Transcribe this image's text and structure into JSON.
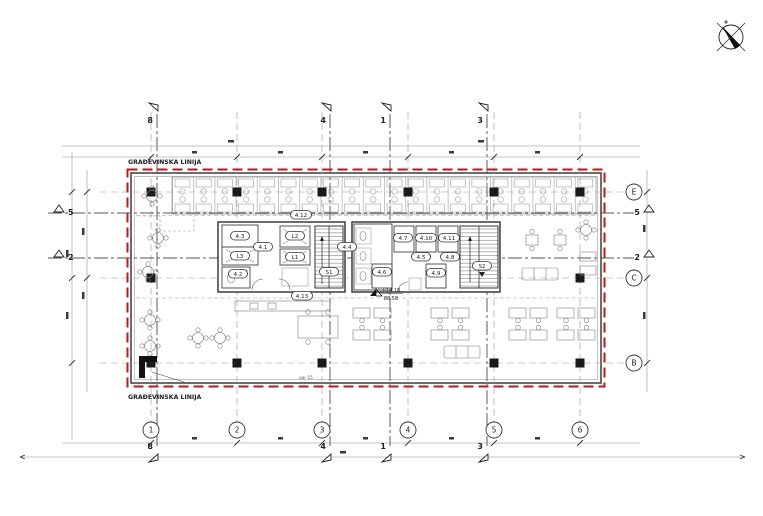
{
  "notes": {
    "building_line_top": "GRAĐEVINSKA LINIJA",
    "building_line_bottom": "GRAĐEVINSKA LINIJA",
    "par": "par 15"
  },
  "colors": {
    "building_line": "#cc1111"
  },
  "grid": {
    "columns": [
      "1",
      "2",
      "3",
      "4",
      "5",
      "6"
    ],
    "rows": [
      "E",
      "C",
      "B"
    ]
  },
  "sections": {
    "vertical": [
      "8",
      "4",
      "1",
      "3"
    ],
    "horizontal": [
      "5",
      "2"
    ]
  },
  "rooms": {
    "r41": "4.1",
    "r42": "4.2",
    "r43": "4.3",
    "r44": "4.4",
    "r45": "4.5",
    "r46": "4.6",
    "r47": "4.7",
    "r48": "4.8",
    "r49": "4.9",
    "r410": "4.10",
    "r411": "4.11",
    "r412": "4.12",
    "r413": "4.13",
    "l1": "L1",
    "l2": "L2",
    "l3": "L3",
    "s1": "S1",
    "s2": "S2"
  },
  "level": {
    "relative": "+14.18",
    "absolute": "88.58"
  },
  "icons": {
    "compass": "north-arrow"
  }
}
